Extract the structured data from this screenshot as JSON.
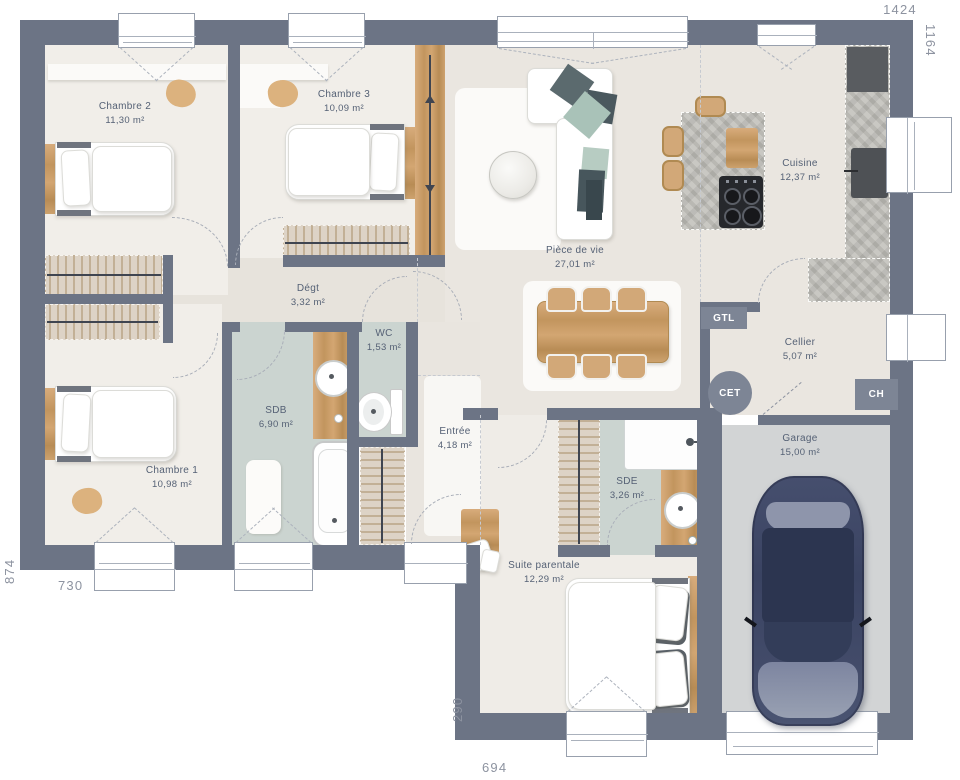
{
  "plan": {
    "type": "house-floor-plan",
    "rooms": [
      {
        "id": "chambre2",
        "name": "Chambre 2",
        "area": "11,30 m²"
      },
      {
        "id": "chambre3",
        "name": "Chambre 3",
        "area": "10,09 m²"
      },
      {
        "id": "piece_de_vie",
        "name": "Pièce de vie",
        "area": "27,01 m²"
      },
      {
        "id": "cuisine",
        "name": "Cuisine",
        "area": "12,37 m²"
      },
      {
        "id": "degagement",
        "name": "Dégt",
        "area": "3,32 m²"
      },
      {
        "id": "wc",
        "name": "WC",
        "area": "1,53 m²"
      },
      {
        "id": "sdb",
        "name": "SDB",
        "area": "6,90 m²"
      },
      {
        "id": "chambre1",
        "name": "Chambre 1",
        "area": "10,98 m²"
      },
      {
        "id": "entree",
        "name": "Entrée",
        "area": "4,18 m²"
      },
      {
        "id": "cellier",
        "name": "Cellier",
        "area": "5,07 m²"
      },
      {
        "id": "sde",
        "name": "SDE",
        "area": "3,26 m²"
      },
      {
        "id": "suite_parentale",
        "name": "Suite parentale",
        "area": "12,29 m²"
      },
      {
        "id": "garage",
        "name": "Garage",
        "area": "15,00 m²"
      }
    ],
    "tech_labels": {
      "gtl": "GTL",
      "cet": "CET",
      "ch": "CH"
    },
    "dimensions": {
      "top": "1424",
      "right": "1164",
      "left": "874",
      "bottom_left": "730",
      "bottom_inner": "290",
      "bottom": "694"
    },
    "colors": {
      "wall": "#6c7485",
      "floor": "#eae6e0",
      "bedroom_floor": "#f1eee9",
      "bath_floor": "#cbd4d0",
      "garage_floor": "#d2d4d5",
      "wood": "#cda26e",
      "concrete": "#bcbbb6",
      "tech_badge": "#7d8595",
      "car_body": "#3d4663",
      "label_text": "#556175",
      "dim_text": "#8d93a0"
    }
  }
}
